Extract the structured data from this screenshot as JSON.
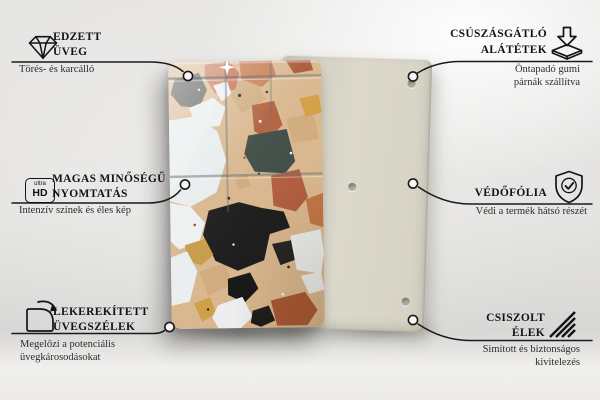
{
  "callouts": [
    {
      "id": "tempered-glass",
      "side": "left",
      "icon": "diamond-icon",
      "title_lines": [
        "EDZETT",
        "ÜVEG"
      ],
      "subtitle_lines": [
        "Törés- és karcálló"
      ]
    },
    {
      "id": "high-quality-print",
      "side": "left",
      "icon": "ultra-hd-icon",
      "title_lines": [
        "MAGAS MINŐSÉGŰ",
        "NYOMTATÁS"
      ],
      "subtitle_lines": [
        "Intenzív színek és éles kép"
      ]
    },
    {
      "id": "rounded-glass-edges",
      "side": "left",
      "icon": "rounded-corner-icon",
      "title_lines": [
        "LEKEREKÍTETT",
        "ÜVEGSZÉLEK"
      ],
      "subtitle_lines": [
        "Megelőzi a potenciális",
        "üvegkárosodásokat"
      ]
    },
    {
      "id": "anti-slip-pads",
      "side": "right",
      "icon": "anti-slip-pads-icon",
      "title_lines": [
        "CSÚSZÁSGÁTLÓ",
        "ALÁTÉTEK"
      ],
      "subtitle_lines": [
        "Öntapadó gumi",
        "párnák szállítva"
      ]
    },
    {
      "id": "protective-film",
      "side": "right",
      "icon": "shield-check-icon",
      "title_lines": [
        "VÉDŐFÓLIA"
      ],
      "subtitle_lines": [
        "Védi a termék hátsó részét"
      ]
    },
    {
      "id": "polished-edges",
      "side": "right",
      "icon": "polished-edge-icon",
      "title_lines": [
        "CSISZOLT",
        "ÉLEK"
      ],
      "subtitle_lines": [
        "Simított és biztonságos",
        "kivitelezés"
      ]
    }
  ],
  "icons": {
    "ultra_hd_badge": {
      "top": "ultra",
      "bottom": "HD"
    }
  },
  "product": {
    "back_panel_color": "#d8d5c8",
    "visible_mounting_holes": 3,
    "front_panel_finish": "glass-with-terrazzo-print"
  },
  "colors": {
    "background": "#e7e6e4",
    "connector_line": "#1a1a1a",
    "text": "#141414",
    "terrazzo_palette": {
      "base_tan": "#d7b48a",
      "white": "#eaeeee",
      "black": "#141414",
      "slate": "#38463f",
      "rust": "#ad5837",
      "salmon": "#c06a48",
      "copper": "#bf7040",
      "amber": "#d09b3e",
      "charcoal": "#4a4a47"
    }
  }
}
